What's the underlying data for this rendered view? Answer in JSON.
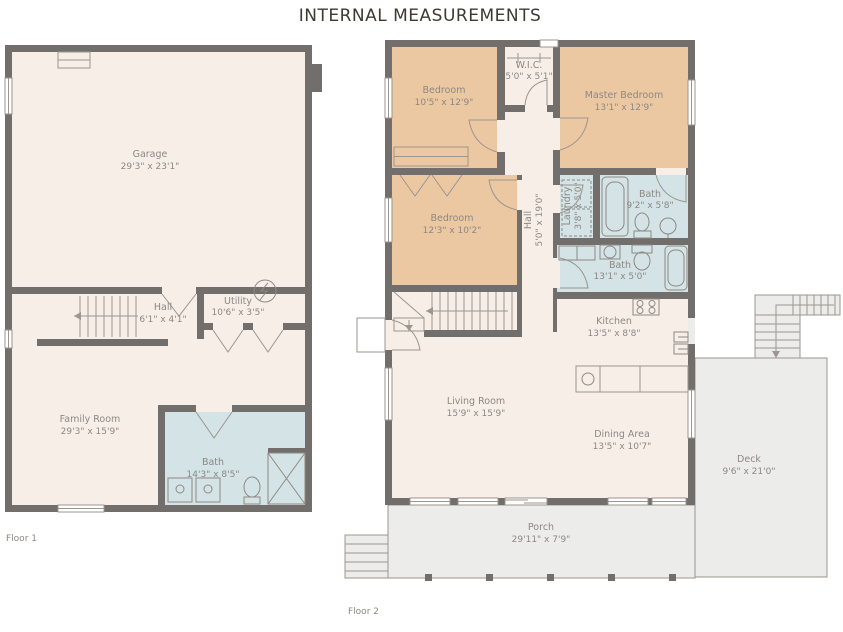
{
  "title": "INTERNAL MEASUREMENTS",
  "colors": {
    "wall": "#716e6b",
    "room_fill": "#f7eee8",
    "bedroom_fill": "#ecc8a2",
    "bath_fill": "#d3e3e6",
    "outdoor_fill": "#ececeb",
    "label_text": "#8d8883",
    "title_text": "#3d3935"
  },
  "floor1": {
    "label": "Floor 1",
    "rooms": [
      {
        "name": "Garage",
        "dims": "29'3\" x 23'1\""
      },
      {
        "name": "Hall",
        "dims": "6'1\" x 4'1\""
      },
      {
        "name": "Utility",
        "dims": "10'6\" x 3'5\""
      },
      {
        "name": "Family Room",
        "dims": "29'3\" x 15'9\""
      },
      {
        "name": "Bath",
        "dims": "14'3\" x 8'5\""
      }
    ]
  },
  "floor2": {
    "label": "Floor 2",
    "rooms": [
      {
        "name": "Bedroom",
        "dims": "10'5\" x 12'9\""
      },
      {
        "name": "W.I.C.",
        "dims": "5'0\" x 5'1\""
      },
      {
        "name": "Master Bedroom",
        "dims": "13'1\" x 12'9\""
      },
      {
        "name": "Bedroom",
        "dims": "12'3\" x 10'2\""
      },
      {
        "name": "Hall",
        "dims": "5'0\" x 19'0\""
      },
      {
        "name": "Laundry",
        "dims": "3'8\" x 5'0\""
      },
      {
        "name": "Bath",
        "dims": "9'2\" x 5'8\""
      },
      {
        "name": "Bath",
        "dims": "13'1\" x 5'0\""
      },
      {
        "name": "Kitchen",
        "dims": "13'5\" x 8'8\""
      },
      {
        "name": "Living Room",
        "dims": "15'9\" x 15'9\""
      },
      {
        "name": "Dining Area",
        "dims": "13'5\" x 10'7\""
      },
      {
        "name": "Deck",
        "dims": "9'6\" x 21'0\""
      },
      {
        "name": "Porch",
        "dims": "29'11\" x 7'9\""
      }
    ]
  }
}
